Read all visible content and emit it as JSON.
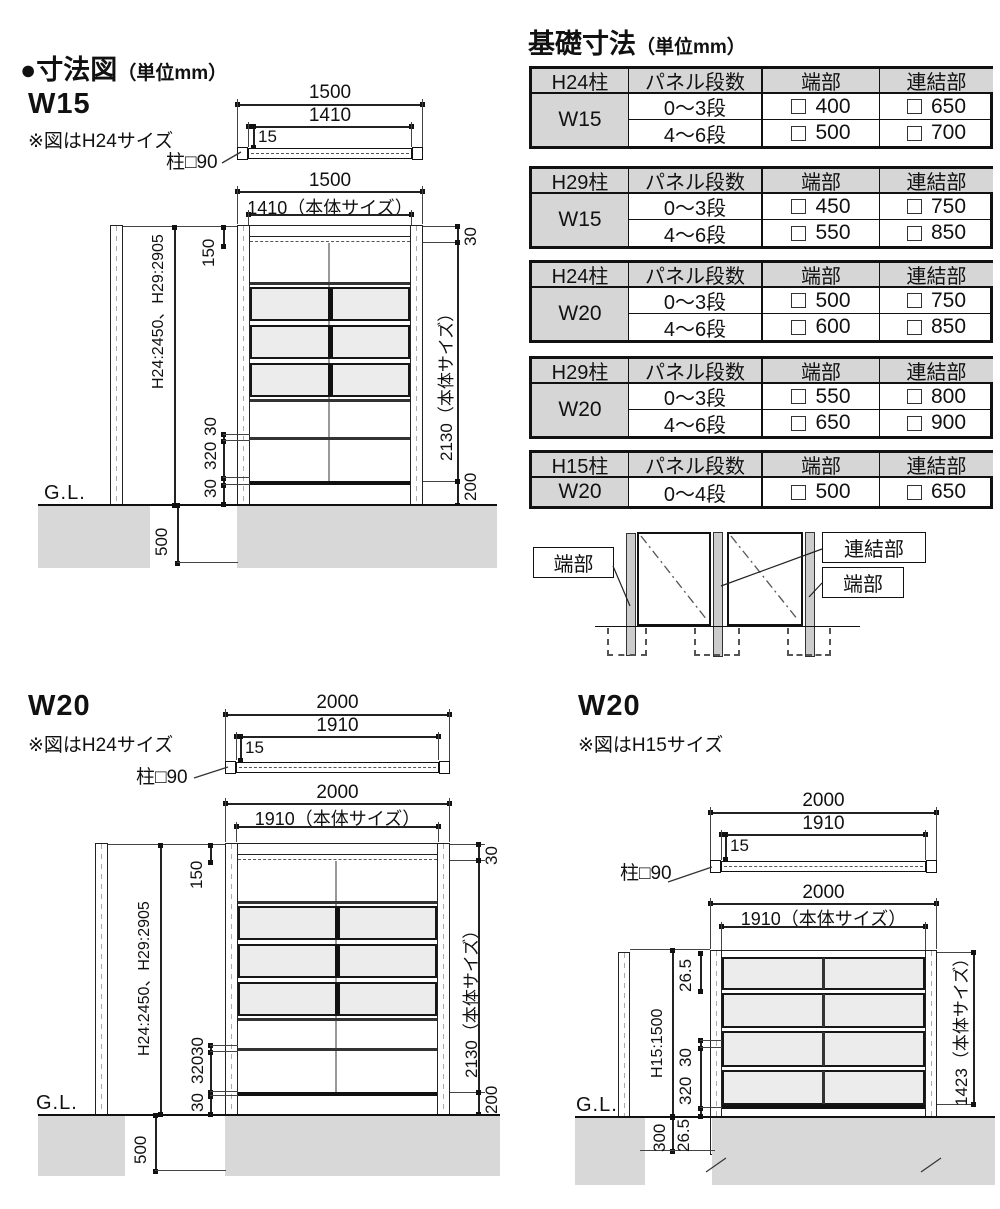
{
  "header": {
    "title": "●寸法図",
    "unit": "（単位mm）"
  },
  "w15": {
    "name": "W15",
    "note": "※図はH24サイズ",
    "post_label": "柱□90",
    "top_outer": "1500",
    "top_inner": "1410",
    "top_offset": "15",
    "front_outer": "1500",
    "front_inner": "1410（本体サイズ）",
    "top_gap": "150",
    "top_right_gap": "30",
    "height_label": "H24:2450、H29:2905",
    "body_height": "2130（本体サイズ）",
    "rail_a": "30",
    "rail_gap": "320",
    "rail_b": "30",
    "bottom_gap": "200",
    "embed_depth": "500",
    "ground_label": "G.L."
  },
  "w20h24": {
    "name": "W20",
    "note": "※図はH24サイズ",
    "post_label": "柱□90",
    "top_outer": "2000",
    "top_inner": "1910",
    "top_offset": "15",
    "front_outer": "2000",
    "front_inner": "1910（本体サイズ）",
    "top_gap": "150",
    "top_right_gap": "30",
    "height_label": "H24:2450、H29:2905",
    "body_height": "2130（本体サイズ）",
    "rail_a": "30",
    "rail_gap": "320",
    "rail_b": "30",
    "bottom_gap": "200",
    "embed_depth": "500",
    "ground_label": "G.L."
  },
  "w20h15": {
    "name": "W20",
    "note": "※図はH15サイズ",
    "post_label": "柱□90",
    "top_outer": "2000",
    "top_inner": "1910",
    "top_offset": "15",
    "front_outer": "2000",
    "front_inner": "1910（本体サイズ）",
    "top_gap": "26.5",
    "height_label": "H15:1500",
    "body_height": "1423（本体サイズ）",
    "rail_a": "30",
    "rail_gap": "320",
    "bottom_gap_label": "26.5",
    "embed_depth": "300",
    "ground_label": "G.L."
  },
  "foundation": {
    "title": "基礎寸法",
    "unit": "（単位mm）",
    "headers": {
      "panel_steps": "パネル段数",
      "end": "端部",
      "joint": "連結部"
    },
    "tables": [
      {
        "post": "H24柱",
        "size": "W15",
        "rows": [
          {
            "steps": "0〜3段",
            "end": "400",
            "joint": "650"
          },
          {
            "steps": "4〜6段",
            "end": "500",
            "joint": "700"
          }
        ]
      },
      {
        "post": "H29柱",
        "size": "W15",
        "rows": [
          {
            "steps": "0〜3段",
            "end": "450",
            "joint": "750"
          },
          {
            "steps": "4〜6段",
            "end": "550",
            "joint": "850"
          }
        ]
      },
      {
        "post": "H24柱",
        "size": "W20",
        "rows": [
          {
            "steps": "0〜3段",
            "end": "500",
            "joint": "750"
          },
          {
            "steps": "4〜6段",
            "end": "600",
            "joint": "850"
          }
        ]
      },
      {
        "post": "H29柱",
        "size": "W20",
        "rows": [
          {
            "steps": "0〜3段",
            "end": "550",
            "joint": "800"
          },
          {
            "steps": "4〜6段",
            "end": "650",
            "joint": "900"
          }
        ]
      },
      {
        "post": "H15柱",
        "size": "W20",
        "rows": [
          {
            "steps": "0〜4段",
            "end": "500",
            "joint": "650"
          }
        ]
      }
    ],
    "legend": {
      "end_left": "端部",
      "joint": "連結部",
      "end_right": "端部"
    }
  },
  "colors": {
    "ground": "#d8d8d8",
    "panel_fill": "#ececec",
    "table_header_bg": "#d6d6d6",
    "line": "#1a1a1a"
  }
}
